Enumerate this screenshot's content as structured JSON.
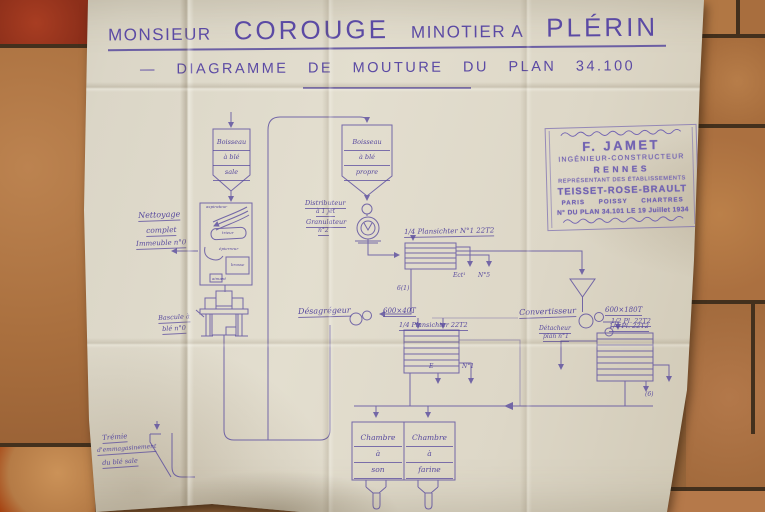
{
  "header": {
    "prefix": "MONSIEUR",
    "name": "COROUGE",
    "occupation": "MINOTIER A",
    "city": "PLÉRIN",
    "subtitle": "— DIAGRAMME DE MOUTURE DU PLAN 34.100"
  },
  "stamp": {
    "name": "F. JAMET",
    "title": "INGÉNIEUR-CONSTRUCTEUR",
    "city": "RENNES",
    "representative": "REPRÉSENTANT DES ÉTABLISSEMENTS",
    "firm": "TEISSET-ROSE-BRAULT",
    "branches": "PARIS POISSY CHARTRES",
    "plan": "N° DU PLAN 34.101 LE 19 Juillet 1934"
  },
  "diagram": {
    "dirty_bin": [
      "Boisseau",
      "à blé",
      "sale"
    ],
    "clean_bin": [
      "Boisseau",
      "à blé",
      "propre"
    ],
    "cleaning_label": [
      "Nettoyage",
      "complet",
      "Immeuble n°0"
    ],
    "cleaning_machines": [
      "aspirateur",
      "trieur",
      "épierreur",
      "brosse",
      "aimant"
    ],
    "bascule": [
      "Bascule à",
      "blé n°0"
    ],
    "tremie": [
      "Trémie",
      "d'emmagasinement",
      "du blé sale"
    ],
    "distributor": [
      "Distributeur",
      "à 1 jet"
    ],
    "granulator": [
      "Granulateur",
      "n°2"
    ],
    "plansichter1": "1/4 Plansichter N°1 22T2",
    "plansichter2": "1/4 Plansichter 22T2",
    "plansichter3": "1/4 Pl. 22T2",
    "desagregeur": "Désagrégeur",
    "desagregeur_spec": "600×40T",
    "convertisseur": "Convertisseur",
    "convertisseur_spec": "600×180T",
    "convertisseur_sub": "1/2 Pl. 22T2",
    "detacheur": [
      "Détacheur",
      "plan n°1"
    ],
    "chamber_bran": [
      "Chambre",
      "à",
      "son"
    ],
    "chamber_flour": [
      "Chambre",
      "à",
      "farine"
    ],
    "ann_ect": "Ect¹",
    "ann_n5": "N°5",
    "ann_61": "6(1)",
    "ann_e": "E",
    "ann_n1": "N°1",
    "ann_6": "(6)"
  },
  "colors": {
    "ink": "#584a9e",
    "stamp_ink": "#7263b2",
    "paper": "#e0dbcc",
    "tile": "#b07a45",
    "tile_red": "#9c3b24",
    "grout": "#43301d"
  },
  "icons": {
    "flow_arrow": "triangle-arrowhead",
    "stamp_ornament": "scroll-flourish"
  }
}
